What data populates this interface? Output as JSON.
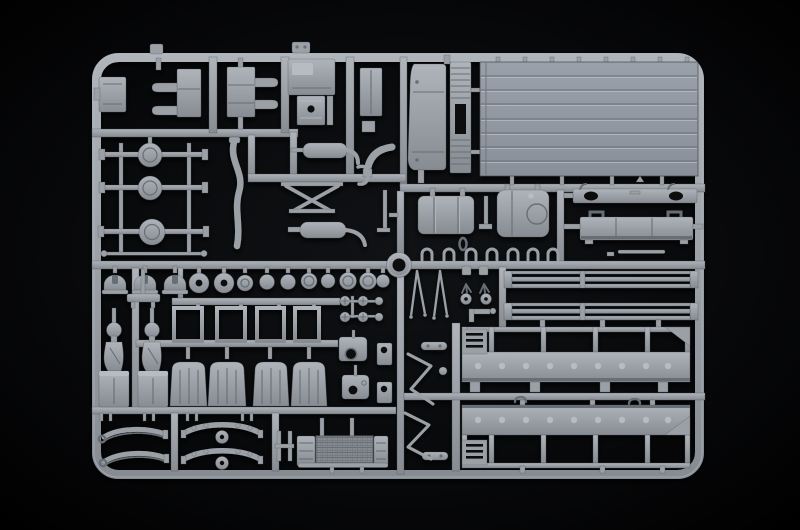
{
  "scene": {
    "description": "Photograph of a light grey injection-moulded polystyrene sprue (model-kit parts frame) for a military truck kit, shot on a black background",
    "subject": "model kit sprue with truck parts",
    "background_look": "black studio background with faint centre glow"
  },
  "colors": {
    "background": "#020203",
    "plastic": "#9aa0a6",
    "plastic_light": "#b6bcc2",
    "plastic_dark": "#686e74",
    "plastic_deep": "#44484d",
    "hole": "#08090a"
  },
  "parts": {
    "frame": {
      "label": "Sprue outer frame",
      "count": 1
    },
    "runners": {
      "label": "Internal runner bars",
      "count": 1
    },
    "gate_ring": {
      "label": "Central round gate ring",
      "count": 1
    },
    "tab_a": {
      "label": "Small tab on top frame rail (left)",
      "count": 1
    },
    "tab_b": {
      "label": "Small tab on top frame rail (centre)",
      "count": 1
    },
    "box_left": {
      "label": "Small storage box on left frame rail",
      "count": 1
    },
    "toolbox_a": {
      "label": "Toolbox with two bullet-shaped handles (left)",
      "count": 1
    },
    "toolbox_b": {
      "label": "Toolbox with two bullet-shaped handles (right)",
      "count": 1
    },
    "hatch_panel": {
      "label": "Hatch panel with recessed corner",
      "count": 1
    },
    "filler_box": {
      "label": "Small box with round filler hole",
      "count": 1
    },
    "step_box": {
      "label": "Tall step box",
      "count": 1
    },
    "arc_bracket": {
      "label": "Curved corner bracket",
      "count": 1
    },
    "cab_panel": {
      "label": "Rounded cab side panel",
      "count": 1
    },
    "grille_panel": {
      "label": "Tall vented grille panel with centre slot",
      "count": 1
    },
    "bed_floor": {
      "label": "Planked cargo-bed floor panel",
      "count": 1
    },
    "fuel_tank_a": {
      "label": "Fuel tank with two straps",
      "count": 1
    },
    "fuel_tank_b": {
      "label": "Fuel tank with round end cap",
      "count": 1
    },
    "link_part": {
      "label": "Small link and pin parts between tanks",
      "count": 2
    },
    "bumper_plate": {
      "label": "Bumper plate with oval recesses",
      "count": 1
    },
    "storage_box": {
      "label": "Under-bed storage box with lifting hooks",
      "count": 1
    },
    "tie_rod": {
      "label": "Thin tie rod",
      "count": 1
    },
    "shackle_clamps": {
      "label": "Row of small U-shackle clamps",
      "count": 7
    },
    "axles": {
      "label": "Drive axles with differential housings",
      "count": 3
    },
    "track_rod": {
      "label": "Long track rod",
      "count": 1
    },
    "exhaust_pipe": {
      "label": "S-shaped exhaust downpipe",
      "count": 1
    },
    "muffler_a": {
      "label": "Muffler, upper",
      "count": 1
    },
    "muffler_b": {
      "label": "Muffler with tail pipe, lower",
      "count": 1
    },
    "engine_brace": {
      "label": "Crossed frame brace",
      "count": 1
    },
    "j_hook": {
      "label": "J-hook",
      "count": 1
    },
    "drain_rod": {
      "label": "Thin vertical rod with foot",
      "count": 1
    },
    "drum_caps": {
      "label": "Dome-shaped drum caps",
      "count": 3
    },
    "wheel_hubs": {
      "label": "Row of wheel hubs and discs",
      "count": 10
    },
    "bolt_fittings": {
      "label": "Cluster of slotted bolt fittings",
      "count": 6
    },
    "cover_plates": {
      "label": "Cover plates with openings",
      "count": 4
    },
    "window_frames": {
      "label": "Open window frames",
      "count": 4
    },
    "mudguard_row": {
      "label": "Ribbed mudguard panels",
      "count": 4
    },
    "air_cleaners": {
      "label": "Air-cleaner units with dome tops",
      "count": 2
    },
    "bracket_small": {
      "label": "Small mounting bracket",
      "count": 1
    },
    "springs_small": {
      "label": "Leaf springs with eye ends (left pair)",
      "count": 2
    },
    "springs_large": {
      "label": "Bogie leaf springs with centre hub (right pair)",
      "count": 2
    },
    "h_bracket": {
      "label": "H-shaped bracket",
      "count": 1
    },
    "radiator": {
      "label": "Radiator core with mesh and side brackets",
      "count": 1
    },
    "mirror_arms": {
      "label": "Forked mirror arms",
      "count": 2
    },
    "grab_handles": {
      "label": "Bent-wire grab handles",
      "count": 2
    },
    "hand_bars": {
      "label": "Rounded handle bars",
      "count": 2
    },
    "hook_pair": {
      "label": "Tiny hooks on centre runner",
      "count": 2
    },
    "small_brackets": {
      "label": "Small clamp and knob parts",
      "count": 6
    },
    "stake_rails": {
      "label": "Long slatted drop-side rails",
      "count": 2
    },
    "side_panel_upper": {
      "label": "Cargo-bed side panel with stake openings (upper)",
      "count": 1
    },
    "side_panel_lower": {
      "label": "Cargo-bed side panel with stake openings (lower)",
      "count": 1
    }
  }
}
